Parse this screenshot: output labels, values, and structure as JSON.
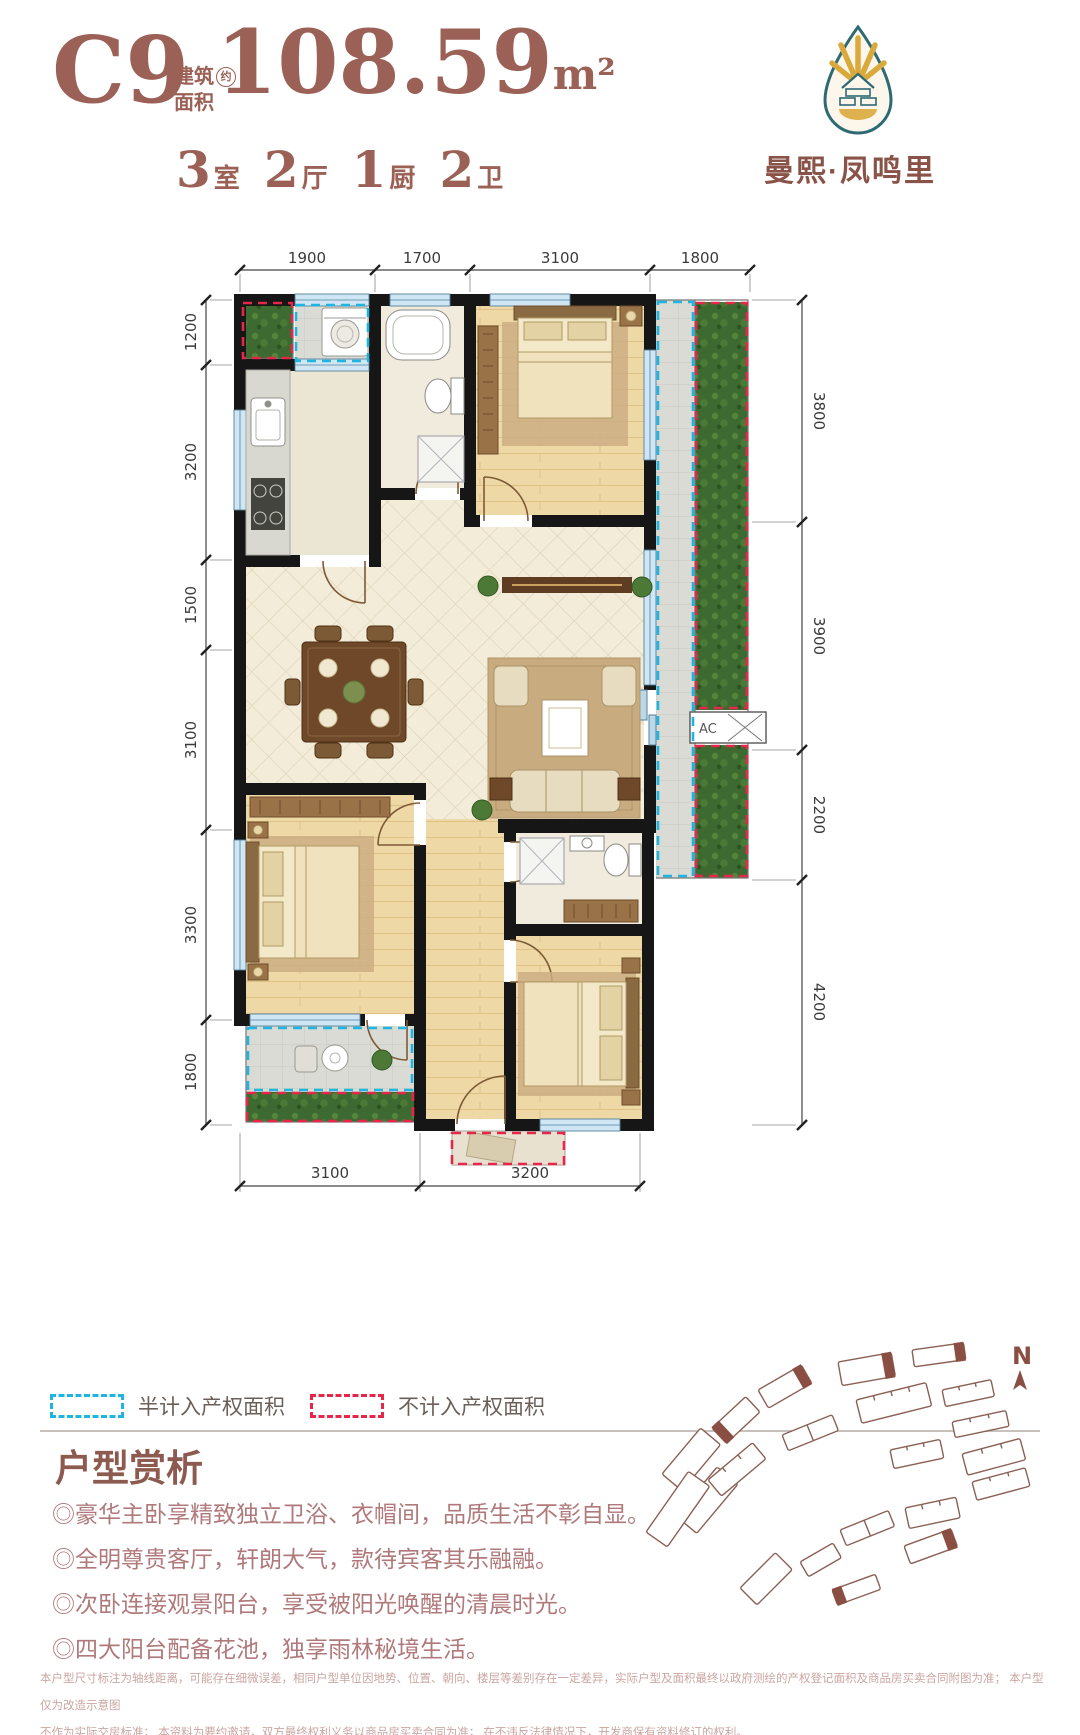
{
  "header": {
    "unit_code": "C9",
    "area_label": {
      "line1": "建筑",
      "approx": "约",
      "line2": "面积"
    },
    "area_value": "108.59",
    "area_unit": "m²",
    "rooms": [
      {
        "num": "3",
        "label": "室"
      },
      {
        "num": "2",
        "label": "厅"
      },
      {
        "num": "1",
        "label": "厨"
      },
      {
        "num": "2",
        "label": "卫"
      }
    ],
    "brand": "曼熙·凤鸣里"
  },
  "floorplan": {
    "dims_top": [
      "1900",
      "1700",
      "3100",
      "1800"
    ],
    "dims_left": [
      "1200",
      "3200",
      "1500",
      "3100",
      "3300",
      "1800"
    ],
    "dims_right": [
      "3800",
      "3900",
      "2200",
      "4200"
    ],
    "dims_bottom": [
      "3100",
      "3200"
    ],
    "ac_label": "AC"
  },
  "legend": {
    "items": [
      {
        "label": "半计入产权面积",
        "color": "#1eb5e0"
      },
      {
        "label": "不计入产权面积",
        "color": "#e6274a"
      }
    ]
  },
  "analysis": {
    "title": "户型赏析",
    "bullets": [
      "◎豪华主卧享精致独立卫浴、衣帽间，品质生活不彰自显。",
      "◎全明尊贵客厅，轩朗大气，款待宾客其乐融融。",
      "◎次卧连接观景阳台，享受被阳光唤醒的清晨时光。",
      "◎四大阳台配备花池，独享雨林秘境生活。"
    ]
  },
  "siteplan": {
    "north_label": "N"
  },
  "disclaimer": {
    "line1": "本户型尺寸标注为轴线距离，可能存在细微误差，相同户型单位因地势、位置、朝向、楼层等差别存在一定差异，实际户型及面积最终以政府测绘的产权登记面积及商品房买卖合同附图为准； 本户型仅为改造示意图",
    "line2": "不作为实际交房标准； 本资料为要约邀请，双方最终权利义务以商品房买卖合同为准； 在不违反法律情况下，开发商保有资料修订的权利。"
  },
  "colors": {
    "accent_brown": "#9c6156",
    "bullet_rose": "#b0797b",
    "dash_blue": "#1eb5e0",
    "dash_red": "#e6274a",
    "wall_black": "#161616",
    "site_outline": "#8a6055",
    "logo_gold": "#d9a93c",
    "logo_teal": "#2e6a74"
  }
}
